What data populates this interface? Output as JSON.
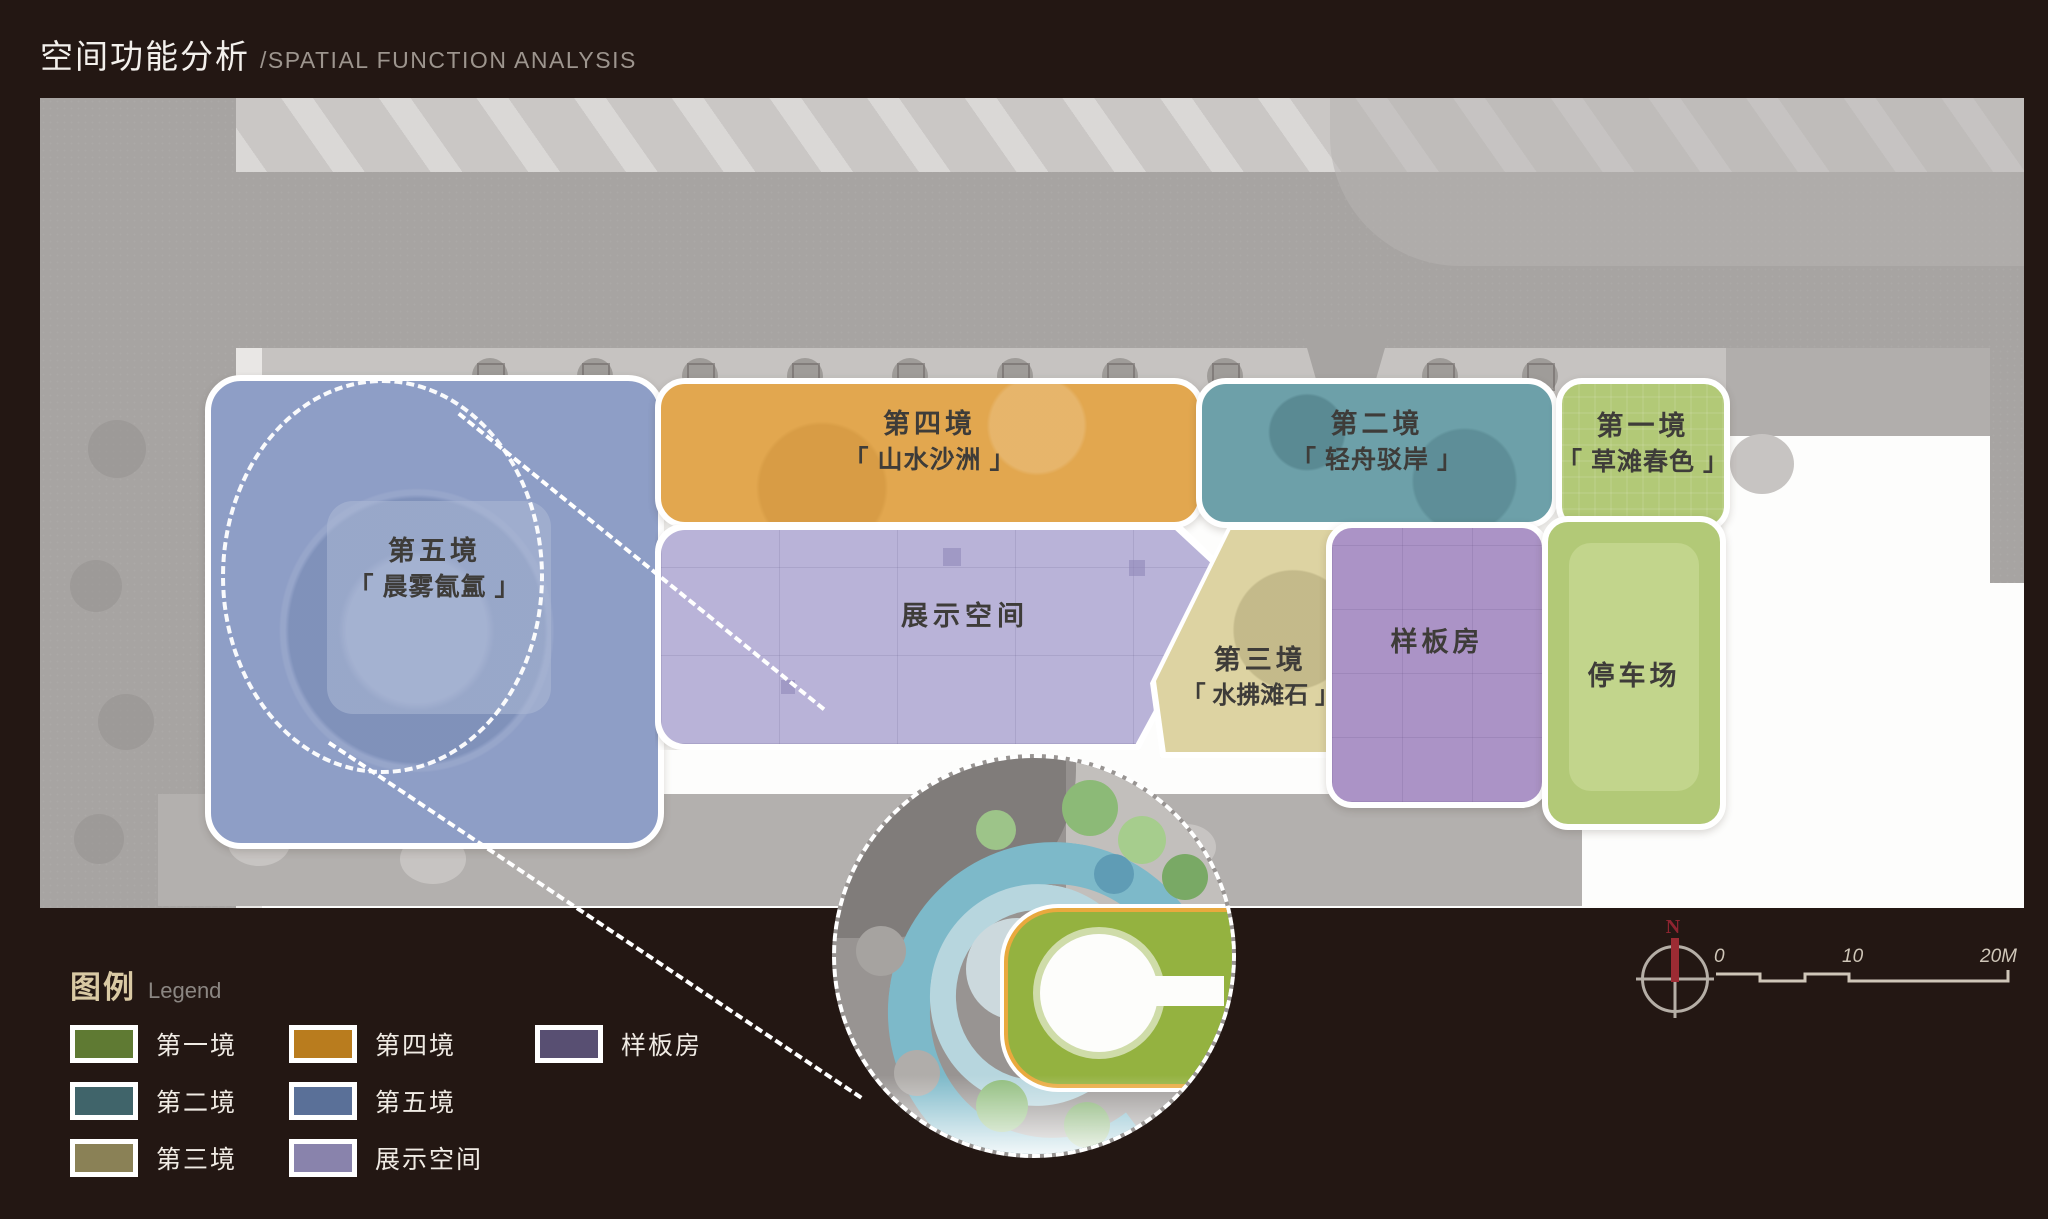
{
  "page": {
    "title_zh": "空间功能分析",
    "title_en": "/SPATIAL FUNCTION ANALYSIS",
    "background": "#231713"
  },
  "zones": {
    "zone5": {
      "title": "第五境",
      "subtitle": "「 晨雾氤氲 」",
      "color": "#8e9ec6"
    },
    "zone4": {
      "title": "第四境",
      "subtitle": "「 山水沙洲 」",
      "color": "#e2a74f"
    },
    "zone2": {
      "title": "第二境",
      "subtitle": "「 轻舟驳岸 」",
      "color": "#6da0a9"
    },
    "zone1": {
      "title": "第一境",
      "subtitle": "「 草滩春色 」",
      "color": "#b2c977"
    },
    "zone3": {
      "title": "第三境",
      "subtitle": "「 水拂滩石 」",
      "color": "#ddd3a2"
    },
    "exhibit": {
      "title": "展示空间",
      "color": "#b9b3d8"
    },
    "model_house": {
      "title": "样板房",
      "color": "#ab93c6"
    },
    "parking": {
      "title": "停车场",
      "color": "#b2c977"
    }
  },
  "legend": {
    "title_zh": "图例",
    "title_en": "Legend",
    "items": [
      {
        "label": "第一境",
        "color": "#5f7a33"
      },
      {
        "label": "第二境",
        "color": "#40646a"
      },
      {
        "label": "第三境",
        "color": "#8a8156"
      },
      {
        "label": "第四境",
        "color": "#b97c1e"
      },
      {
        "label": "第五境",
        "color": "#5a7098"
      },
      {
        "label": "展示空间",
        "color": "#8983ac"
      },
      {
        "label": "样板房",
        "color": "#584f72"
      }
    ]
  },
  "compass": {
    "north_label": "N"
  },
  "scalebar": {
    "labels": [
      "0",
      "10",
      "20M"
    ]
  }
}
